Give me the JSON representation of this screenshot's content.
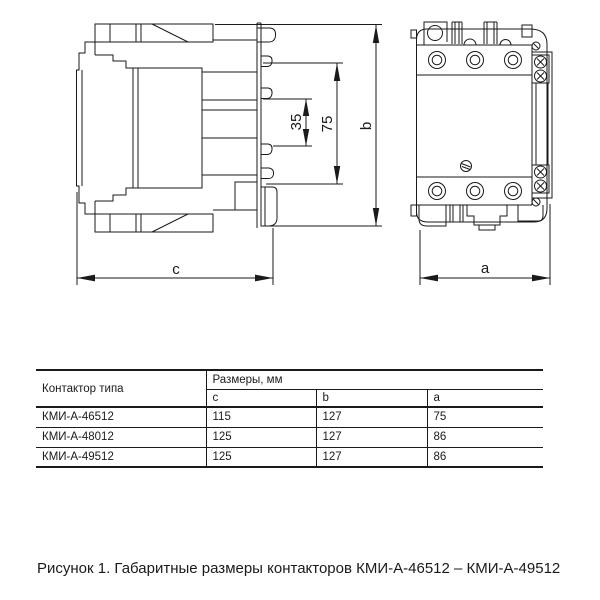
{
  "figure": {
    "dim_labels": {
      "depth_c": "c",
      "width_a": "a",
      "height_b": "b",
      "din_35": "35",
      "din_75": "75"
    }
  },
  "table": {
    "col_type_header": "Контактор типа",
    "dimensions_group_header": "Размеры, мм",
    "sub_headers": {
      "c": "c",
      "b": "b",
      "a": "a"
    },
    "rows": [
      {
        "type": "КМИ-А-46512",
        "c": "115",
        "b": "127",
        "a": "75"
      },
      {
        "type": "КМИ-А-48012",
        "c": "125",
        "b": "127",
        "a": "86"
      },
      {
        "type": "КМИ-А-49512",
        "c": "125",
        "b": "127",
        "a": "86"
      }
    ]
  },
  "caption": "Рисунок 1. Габаритные размеры контакторов КМИ-А-46512 – КМИ-А-49512",
  "colors": {
    "line": "#1a1a1a",
    "text": "#1a1a1a",
    "background": "#ffffff"
  }
}
